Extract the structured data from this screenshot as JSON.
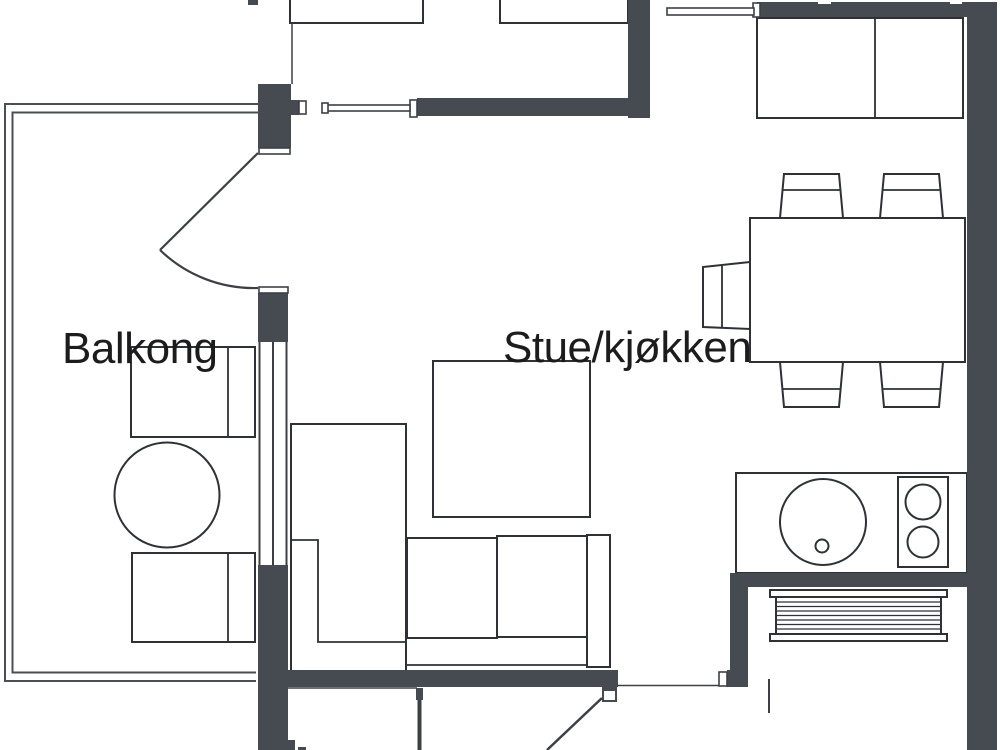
{
  "floorplan": {
    "type": "apartment-floor-plan",
    "labels": {
      "balcony": "Balkong",
      "living_kitchen": "Stue/kjøkken"
    },
    "colors": {
      "background": "#ffffff",
      "wall": "#464a51",
      "furniture_outline": "#2e3136",
      "thin_line": "#3c4046",
      "text": "#1c1c1c"
    },
    "rooms": [
      {
        "name": "Balkong",
        "kind": "balcony"
      },
      {
        "name": "Stue/kjøkken",
        "kind": "living-room-kitchen"
      }
    ],
    "furniture": [
      "balcony-chair-top",
      "balcony-round-table",
      "balcony-chair-bottom",
      "balcony-door-swing",
      "sliding-door-leaf-left",
      "sliding-door-leaf-top",
      "bedroom-cabinet-left",
      "bedroom-cabinet-right",
      "kitchen-wall-cabinets",
      "dining-table",
      "dining-chair-top-left",
      "dining-chair-top-right",
      "dining-chair-bottom-left",
      "dining-chair-bottom-right",
      "dining-chair-left",
      "corner-sofa",
      "coffee-table-square",
      "kitchen-counter",
      "kitchen-sink",
      "kitchen-stove-two-burners",
      "radiator",
      "entrance-door-swing",
      "interior-window"
    ]
  }
}
